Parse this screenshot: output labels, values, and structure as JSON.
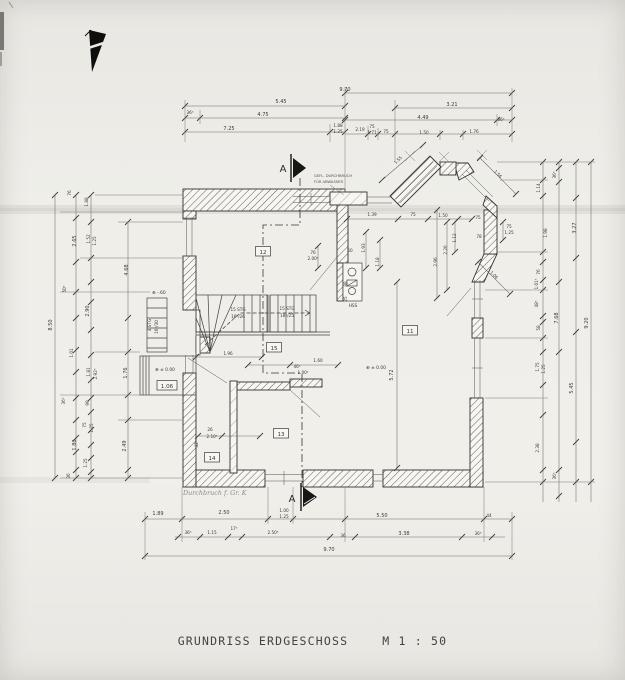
{
  "title": {
    "text": "GRUNDRISS ERDGESCHOSS",
    "scale": "M 1 : 50"
  },
  "rooms": [
    {
      "id": "12",
      "x": 263,
      "y": 254
    },
    {
      "id": "15",
      "x": 274,
      "y": 350
    },
    {
      "id": "11",
      "x": 410,
      "y": 333
    },
    {
      "id": "13",
      "x": 281,
      "y": 436
    },
    {
      "id": "14",
      "x": 212,
      "y": 460
    },
    {
      "id": "1.06",
      "x": 167,
      "y": 388
    }
  ],
  "plan_labels": [
    {
      "t": "9.70",
      "x": 345,
      "y": 91,
      "n": "dim-top"
    },
    {
      "t": "5.45",
      "x": 281,
      "y": 103,
      "n": "dim-top"
    },
    {
      "t": "3.21",
      "x": 452,
      "y": 106,
      "n": "dim-top"
    },
    {
      "t": "36⁵",
      "x": 190,
      "y": 114,
      "k": "s",
      "n": "dim-top"
    },
    {
      "t": "4.75",
      "x": 263,
      "y": 116,
      "n": "dim-top"
    },
    {
      "t": "4.49",
      "x": 423,
      "y": 119,
      "n": "dim-top"
    },
    {
      "t": "36⁵",
      "x": 501,
      "y": 121,
      "k": "s",
      "n": "dim-top"
    },
    {
      "t": "7.25",
      "x": 229,
      "y": 130,
      "n": "dim-top"
    },
    {
      "t": "1.88",
      "x": 338,
      "y": 127,
      "k": "s",
      "n": "dim-top"
    },
    {
      "t": "1.25",
      "x": 338,
      "y": 133,
      "k": "s",
      "n": "dim-top"
    },
    {
      "t": "2.19",
      "x": 360,
      "y": 131,
      "k": "s",
      "n": "dim-top"
    },
    {
      "t": "75",
      "x": 372,
      "y": 128,
      "k": "s",
      "n": "dim-top"
    },
    {
      "t": "1.71",
      "x": 372,
      "y": 134,
      "k": "s",
      "n": "dim-top"
    },
    {
      "t": "75",
      "x": 386,
      "y": 133,
      "k": "s",
      "n": "dim-top"
    },
    {
      "t": "1.50",
      "x": 424,
      "y": 134,
      "k": "s",
      "n": "dim-top"
    },
    {
      "t": "1.76",
      "x": 474,
      "y": 133,
      "k": "s",
      "n": "dim-top"
    },
    {
      "t": "76",
      "x": 71,
      "y": 193,
      "r": -90,
      "k": "s",
      "n": "dim-left"
    },
    {
      "t": "1.88",
      "x": 88,
      "y": 202,
      "r": -90,
      "k": "s",
      "n": "dim-left"
    },
    {
      "t": "2.65",
      "x": 76,
      "y": 241,
      "r": -90,
      "n": "dim-left"
    },
    {
      "t": "1.52",
      "x": 90,
      "y": 239,
      "r": -90,
      "k": "s",
      "n": "dim-left"
    },
    {
      "t": "1.25",
      "x": 96,
      "y": 241,
      "r": -90,
      "k": "s",
      "n": "dim-left"
    },
    {
      "t": "4.68",
      "x": 128,
      "y": 270,
      "r": -90,
      "n": "dim-left"
    },
    {
      "t": "50⁵",
      "x": 66,
      "y": 289,
      "r": -90,
      "k": "s",
      "n": "dim-left"
    },
    {
      "t": "2.90",
      "x": 89,
      "y": 311,
      "r": -90,
      "n": "dim-left"
    },
    {
      "t": "8.50",
      "x": 52,
      "y": 325,
      "r": -90,
      "n": "dim-left"
    },
    {
      "t": "1.01",
      "x": 73,
      "y": 353,
      "r": -90,
      "k": "s",
      "n": "dim-left"
    },
    {
      "t": "1.81",
      "x": 90,
      "y": 372,
      "r": -90,
      "k": "s",
      "n": "dim-left"
    },
    {
      "t": "2.92⁵",
      "x": 97,
      "y": 374,
      "r": -90,
      "k": "s",
      "n": "dim-left"
    },
    {
      "t": "1.76",
      "x": 127,
      "y": 373,
      "r": -90,
      "n": "dim-left"
    },
    {
      "t": "36⁵",
      "x": 65,
      "y": 401,
      "r": -90,
      "k": "s",
      "n": "dim-left"
    },
    {
      "t": "99",
      "x": 89,
      "y": 403,
      "r": -90,
      "k": "s",
      "n": "dim-left"
    },
    {
      "t": "75",
      "x": 86,
      "y": 425,
      "r": -90,
      "k": "s",
      "n": "dim-left"
    },
    {
      "t": "1.25",
      "x": 93,
      "y": 428,
      "r": -90,
      "k": "s",
      "n": "dim-left"
    },
    {
      "t": "1.80",
      "x": 76,
      "y": 445,
      "r": -90,
      "n": "dim-left"
    },
    {
      "t": "2.49",
      "x": 126,
      "y": 446,
      "r": -90,
      "n": "dim-left"
    },
    {
      "t": "1.25",
      "x": 87,
      "y": 463,
      "r": -90,
      "k": "s",
      "n": "dim-left"
    },
    {
      "t": "36",
      "x": 70,
      "y": 476,
      "r": -90,
      "k": "s",
      "n": "dim-left"
    },
    {
      "t": "36⁵",
      "x": 556,
      "y": 175,
      "r": -90,
      "k": "s",
      "n": "dim-right"
    },
    {
      "t": "1.14",
      "x": 540,
      "y": 188,
      "r": -90,
      "k": "s",
      "n": "dim-right"
    },
    {
      "t": "1.98",
      "x": 547,
      "y": 233,
      "r": -90,
      "k": "s",
      "n": "dim-right"
    },
    {
      "t": "3.27",
      "x": 576,
      "y": 228,
      "r": -90,
      "n": "dim-right"
    },
    {
      "t": "76",
      "x": 540,
      "y": 272,
      "r": -90,
      "k": "s",
      "n": "dim-right"
    },
    {
      "t": "1.01⁵",
      "x": 538,
      "y": 284,
      "r": -90,
      "k": "s",
      "n": "dim-right"
    },
    {
      "t": "48⁵",
      "x": 538,
      "y": 304,
      "r": -90,
      "k": "s",
      "n": "dim-right"
    },
    {
      "t": "7.68",
      "x": 558,
      "y": 318,
      "r": -90,
      "n": "dim-right"
    },
    {
      "t": "58",
      "x": 540,
      "y": 328,
      "r": -90,
      "k": "s",
      "n": "dim-right"
    },
    {
      "t": "9.20",
      "x": 588,
      "y": 323,
      "r": -90,
      "n": "dim-right"
    },
    {
      "t": "1.75",
      "x": 539,
      "y": 367,
      "r": -90,
      "k": "s",
      "n": "dim-right"
    },
    {
      "t": "1.25",
      "x": 545,
      "y": 369,
      "r": -90,
      "k": "s",
      "n": "dim-right"
    },
    {
      "t": "5.45",
      "x": 573,
      "y": 388,
      "r": -90,
      "n": "dim-right"
    },
    {
      "t": "2.38",
      "x": 539,
      "y": 448,
      "r": -90,
      "k": "s",
      "n": "dim-right"
    },
    {
      "t": "36⁵",
      "x": 556,
      "y": 476,
      "r": -90,
      "k": "s",
      "n": "dim-right"
    },
    {
      "t": "1.89",
      "x": 158,
      "y": 515,
      "n": "dim-bottom"
    },
    {
      "t": "2.50",
      "x": 224,
      "y": 514,
      "n": "dim-bottom"
    },
    {
      "t": "1.00",
      "x": 284,
      "y": 512,
      "k": "s",
      "n": "dim-bottom"
    },
    {
      "t": "1.25",
      "x": 284,
      "y": 518,
      "k": "s",
      "n": "dim-bottom"
    },
    {
      "t": "5.50",
      "x": 382,
      "y": 517,
      "n": "dim-bottom"
    },
    {
      "t": "44",
      "x": 489,
      "y": 517,
      "k": "s",
      "n": "dim-bottom"
    },
    {
      "t": "36⁵",
      "x": 188,
      "y": 534,
      "k": "s",
      "n": "dim-bottom"
    },
    {
      "t": "1.15",
      "x": 212,
      "y": 534,
      "k": "s",
      "n": "dim-bottom"
    },
    {
      "t": "17⁵",
      "x": 234,
      "y": 530,
      "k": "s",
      "n": "dim-bottom"
    },
    {
      "t": "2.50⁵",
      "x": 273,
      "y": 534,
      "k": "s",
      "n": "dim-bottom"
    },
    {
      "t": "36",
      "x": 343,
      "y": 537,
      "k": "s",
      "n": "dim-bottom"
    },
    {
      "t": "3.38",
      "x": 404,
      "y": 535,
      "n": "dim-bottom"
    },
    {
      "t": "36⁵",
      "x": 478,
      "y": 535,
      "k": "s",
      "n": "dim-bottom"
    },
    {
      "t": "9.70",
      "x": 329,
      "y": 551,
      "n": "dim-bottom"
    },
    {
      "t": "1.39",
      "x": 372,
      "y": 216,
      "k": "s",
      "n": "dim-plan"
    },
    {
      "t": "75",
      "x": 413,
      "y": 216,
      "k": "s",
      "n": "dim-plan"
    },
    {
      "t": "1.50",
      "x": 443,
      "y": 217,
      "k": "s",
      "n": "dim-plan"
    },
    {
      "t": "75",
      "x": 478,
      "y": 219,
      "k": "s",
      "n": "dim-plan"
    },
    {
      "t": "78",
      "x": 479,
      "y": 238,
      "k": "s",
      "n": "dim-plan"
    },
    {
      "t": "75",
      "x": 509,
      "y": 228,
      "k": "s",
      "n": "dim-plan"
    },
    {
      "t": "1.25",
      "x": 509,
      "y": 234,
      "k": "s",
      "n": "dim-plan"
    },
    {
      "t": "1.12",
      "x": 456,
      "y": 238,
      "r": -90,
      "k": "s",
      "n": "dim-plan"
    },
    {
      "t": "2.26",
      "x": 447,
      "y": 250,
      "r": -90,
      "k": "s",
      "n": "dim-plan"
    },
    {
      "t": "2.96",
      "x": 437,
      "y": 262,
      "r": -90,
      "k": "s",
      "n": "dim-plan"
    },
    {
      "t": "1.56",
      "x": 497,
      "y": 175,
      "r": 45,
      "k": "s",
      "n": "dim-plan"
    },
    {
      "t": "1.06",
      "x": 493,
      "y": 276,
      "r": 45,
      "k": "s",
      "n": "dim-plan"
    },
    {
      "t": "1.55",
      "x": 399,
      "y": 161,
      "r": -45,
      "k": "s",
      "n": "dim-plan"
    },
    {
      "t": "76",
      "x": 313,
      "y": 254,
      "k": "s",
      "n": "dim-plan"
    },
    {
      "t": "2.00⁵",
      "x": 313,
      "y": 260,
      "k": "s",
      "n": "dim-plan"
    },
    {
      "t": "50",
      "x": 350,
      "y": 252,
      "k": "s",
      "n": "dim-plan"
    },
    {
      "t": "1.93",
      "x": 365,
      "y": 248,
      "r": -90,
      "k": "s",
      "n": "dim-plan"
    },
    {
      "t": "1.18",
      "x": 379,
      "y": 262,
      "r": -90,
      "k": "s",
      "n": "dim-plan"
    },
    {
      "t": "88",
      "x": 347,
      "y": 284,
      "r": -90,
      "k": "s",
      "n": "dim-plan"
    },
    {
      "t": "25",
      "x": 347,
      "y": 299,
      "r": -90,
      "k": "s",
      "n": "dim-plan"
    },
    {
      "t": "5.72",
      "x": 393,
      "y": 375,
      "r": -90,
      "n": "dim-plan"
    },
    {
      "t": "1.96",
      "x": 228,
      "y": 355,
      "k": "s",
      "n": "dim-plan"
    },
    {
      "t": "1.60",
      "x": 318,
      "y": 362,
      "k": "s",
      "n": "dim-plan"
    },
    {
      "t": "46⁵",
      "x": 297,
      "y": 368,
      "k": "s",
      "n": "dim-plan"
    },
    {
      "t": "1.00⁵",
      "x": 303,
      "y": 374,
      "k": "s",
      "n": "dim-plan"
    },
    {
      "t": "26",
      "x": 210,
      "y": 431,
      "k": "s",
      "n": "dim-plan"
    },
    {
      "t": "2.10⁵",
      "x": 212,
      "y": 438,
      "k": "s",
      "n": "dim-plan"
    },
    {
      "t": "42⁵",
      "x": 198,
      "y": 444,
      "r": -90,
      "k": "s",
      "n": "dim-plan"
    },
    {
      "t": "15 STG",
      "x": 238,
      "y": 311,
      "k": "s",
      "n": "stair-label"
    },
    {
      "t": "18⁵/26",
      "x": 238,
      "y": 318,
      "k": "s",
      "n": "stair-label"
    },
    {
      "t": "15 STG",
      "x": 287,
      "y": 310,
      "k": "s",
      "n": "stair-label"
    },
    {
      "t": "18⁵/25",
      "x": 287,
      "y": 317,
      "k": "s",
      "n": "stair-label"
    },
    {
      "t": "4 STG",
      "x": 151,
      "y": 325,
      "r": -90,
      "k": "s",
      "n": "exterior-stair-label"
    },
    {
      "t": "16⁵/30",
      "x": 158,
      "y": 327,
      "r": -90,
      "k": "s",
      "n": "exterior-stair-label"
    },
    {
      "t": "HSS",
      "x": 353,
      "y": 307,
      "k": "s",
      "n": "chimney-label"
    },
    {
      "t": "⊕ ± 0.00",
      "x": 155,
      "y": 371,
      "k": "lvl",
      "n": "level-marker"
    },
    {
      "t": "⊕ -.60",
      "x": 152,
      "y": 294,
      "k": "lvl",
      "n": "level-marker"
    },
    {
      "t": "⊕ ± 0.00",
      "x": 366,
      "y": 369,
      "k": "lvl",
      "n": "level-marker"
    },
    {
      "t": "GEFL. DURCHBRUCH",
      "x": 314,
      "y": 177,
      "k": "tiny",
      "n": "duct-note-line1"
    },
    {
      "t": "FÜR ABWASSER",
      "x": 314,
      "y": 183,
      "k": "tiny",
      "n": "duct-note-line2"
    },
    {
      "t": "A",
      "x": 283,
      "y": 172,
      "k": "A",
      "n": "section-marker-a-top"
    },
    {
      "t": "A",
      "x": 292,
      "y": 502,
      "k": "A",
      "n": "section-marker-a-bottom"
    },
    {
      "t": "Durchbruch f. Gr. K",
      "x": 183,
      "y": 495,
      "k": "note",
      "n": "handwritten-note"
    }
  ]
}
